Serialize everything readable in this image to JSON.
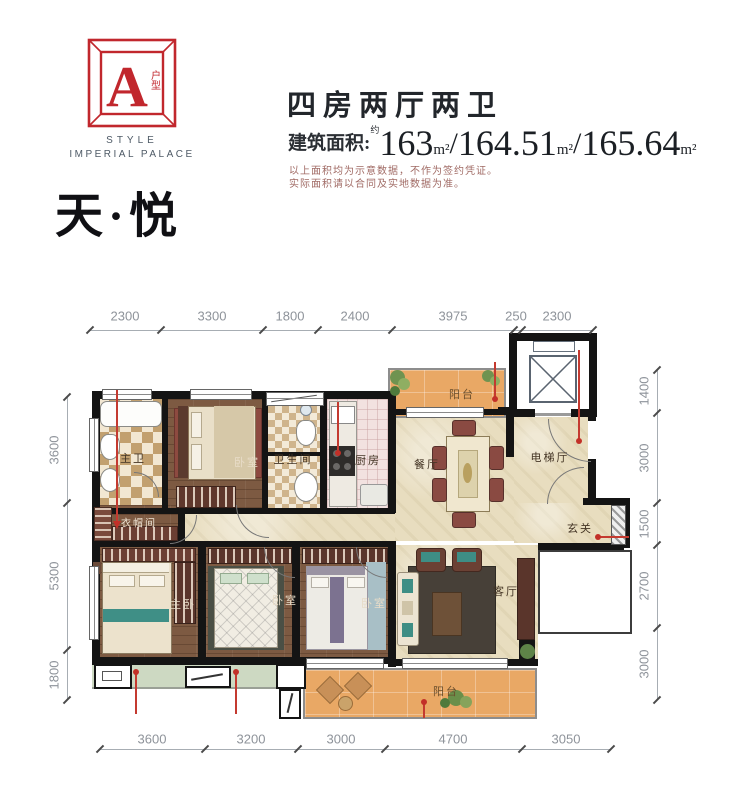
{
  "logo": {
    "letter": "A",
    "tag": "户型",
    "style_word": "STYLE",
    "brand": "IMPERIAL PALACE",
    "project": "天·悦"
  },
  "header": {
    "title": "四房两厅两卫",
    "area_label": "建筑面积:",
    "approx": "约",
    "areas": [
      "163",
      "164.51",
      "165.64"
    ],
    "unit": "m²",
    "slash": "/",
    "disclaimer1": "以上面积均为示意数据，不作为签约凭证。",
    "disclaimer2": "实际面积请以合同及实地数据为准。"
  },
  "rooms": {
    "master_bath": "主卫",
    "bedroom_top": "卧室",
    "bathroom": "卫生间",
    "kitchen": "厨房",
    "dining": "餐厅",
    "elevator_hall": "电梯厅",
    "balcony_top": "阳台",
    "cloakroom": "衣帽间",
    "master_bedroom": "主卧",
    "bedroom_mid": "卧室",
    "bedroom_right": "卧室",
    "living": "客厅",
    "entry": "玄关",
    "balcony_bottom": "阳台"
  },
  "dims": {
    "top": [
      "2300",
      "3300",
      "1800",
      "2400",
      "3975",
      "250",
      "2300"
    ],
    "bottom": [
      "3600",
      "3200",
      "3000",
      "4700",
      "3050"
    ],
    "left": [
      "3600",
      "5300",
      "1800"
    ],
    "right": [
      "1400",
      "3000",
      "1500",
      "2700",
      "3000"
    ]
  },
  "colors": {
    "accent_red": "#c1272d",
    "wall_black": "#141414",
    "marble_floor": "#e8ddbf",
    "wood_floor": "#7d5a42",
    "balcony_floor": "#e9a865",
    "dim_text": "#8e939a"
  }
}
